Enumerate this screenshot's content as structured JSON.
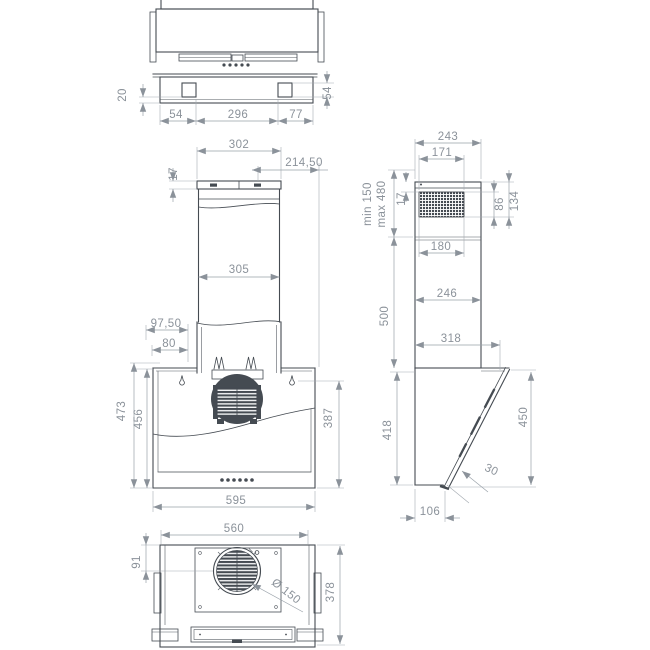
{
  "colors": {
    "background": "#ffffff",
    "outline": "#454b52",
    "dimension_text": "#8b929a",
    "dimension_line": "#99a1a9"
  },
  "views": {
    "top": {
      "dims": {
        "plate_offset": "20",
        "square_size": "54",
        "left_edge_to_square": "54",
        "between_squares": "296",
        "square_to_right_edge": "77"
      }
    },
    "front": {
      "dims": {
        "chimney_top_width": "302",
        "offset_to_right_edge": "214,50",
        "cap_height": "17",
        "chimney_width": "305",
        "offset_97": "97,50",
        "offset_80": "80",
        "height_outer": "473",
        "height_inner": "456",
        "height_right": "387",
        "body_width": "595"
      }
    },
    "side": {
      "dims": {
        "chimney_depth_top": "243",
        "grille_width_top": "171",
        "mount_min": "min 150",
        "mount_max": "max 480",
        "cap_to_grille": "17",
        "grille_height": "86",
        "top_to_grille_bottom": "134",
        "outlet_width": "180",
        "chimney_depth_lower": "246",
        "chimney_height": "500",
        "total_depth": "318",
        "body_height": "418",
        "panel_height": "450",
        "panel_lip": "30",
        "body_depth": "106"
      }
    },
    "bottom": {
      "dims": {
        "inner_width": "560",
        "edge_to_outlet_center": "91",
        "outlet_diameter": "Ø 150",
        "body_depth": "378"
      }
    }
  }
}
